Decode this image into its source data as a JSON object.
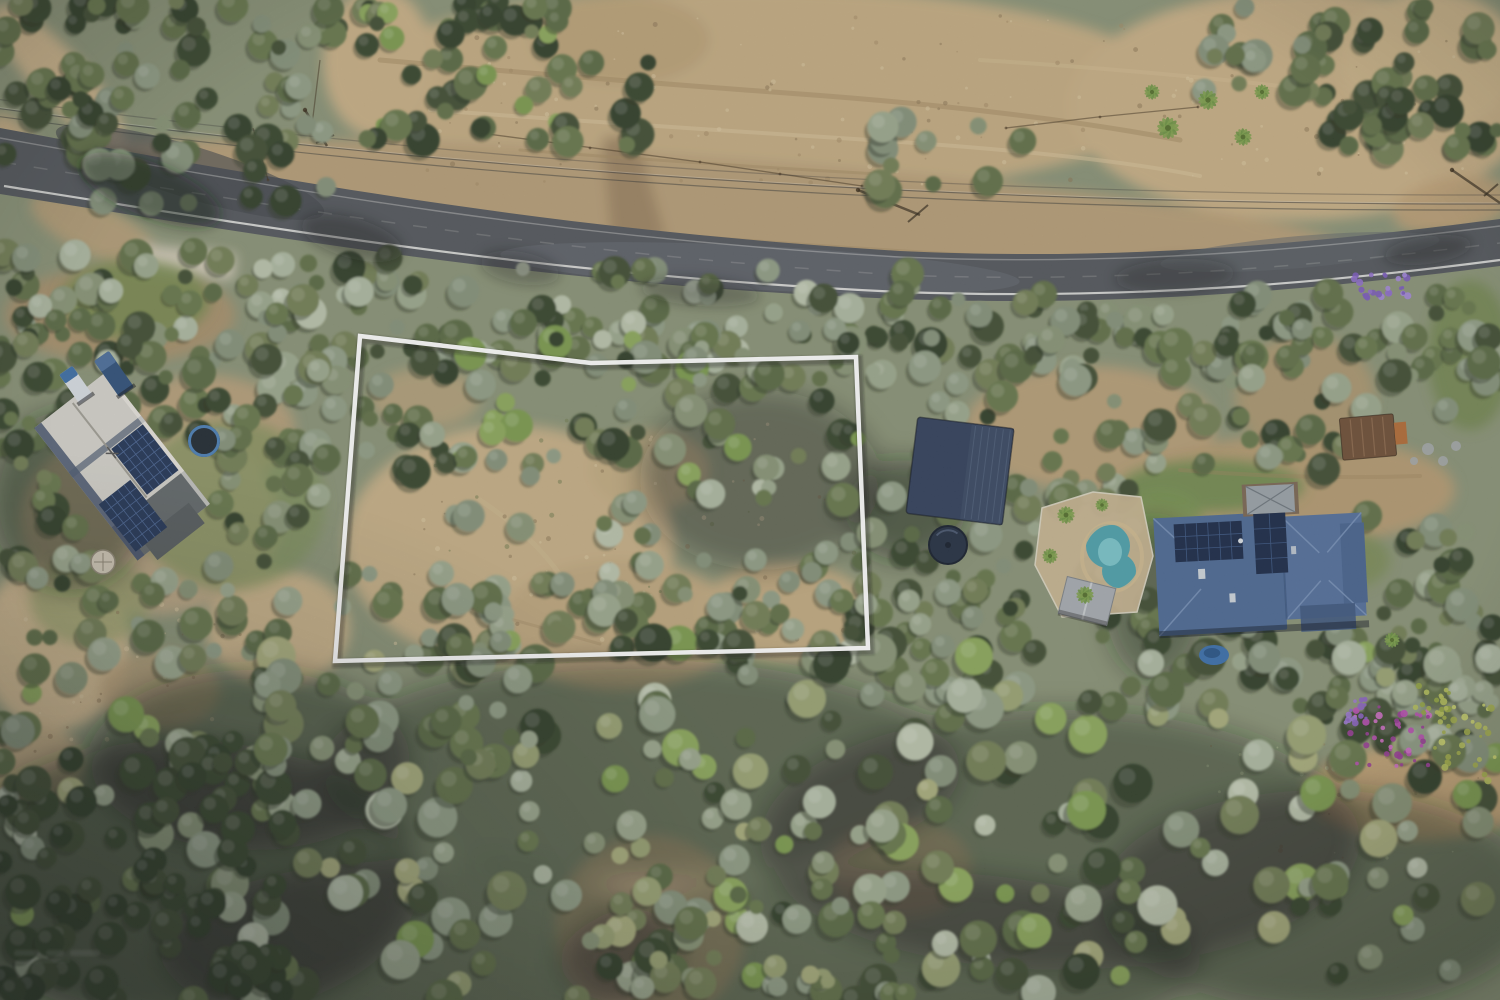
{
  "meta": {
    "type": "aerial-drone-photograph",
    "subject": "rural residential land parcel for sale, marked with white boundary outline, bushland with road at top",
    "width": 1500,
    "height": 1000,
    "seed": 7
  },
  "canvas": {
    "base": "#8a9377"
  },
  "overlay": {
    "boundary": {
      "points": "360,336 591,363 856,357 868,648 335,661",
      "stroke": "#ffffff",
      "stroke_width": 4.5,
      "shadow": "rgba(20,25,20,0.35)"
    }
  },
  "watermark": {
    "text_legible": false,
    "color": "#ffffff",
    "x": 14,
    "y": 950
  },
  "palette": {
    "trees": {
      "dark": [
        "#39462f",
        "#424f36",
        "#33402b"
      ],
      "mid": [
        "#5a6a44",
        "#68784d",
        "#737f56",
        "#627148"
      ],
      "grey": [
        "#85927a",
        "#909d85",
        "#9ba78d",
        "#889476"
      ],
      "silver": [
        "#acb7a0",
        "#b8c1aa"
      ],
      "bright": [
        "#7c9a50",
        "#8ca75c"
      ],
      "khaki": [
        "#99a273",
        "#a7ac7b"
      ]
    },
    "shadow": "#2c3526",
    "road_asphalt": "#54585d",
    "dirt_base": "#bfa77d"
  },
  "road": {
    "surface": "M0,128 C300,184 560,230 900,251 C1150,263 1360,237 1500,219 L1500,266 C1350,285 1150,308 900,299 C560,286 290,240 0,194 Z",
    "fill": "#54585d",
    "fog_line": "M4,186 C300,233 560,276 900,292 C1150,301 1355,279 1500,260",
    "top_line": "M0,138 C300,192 560,238 900,257 C1150,268 1360,243 1500,226",
    "center_line": "M2,162 C300,210 560,254 900,275 C1150,285 1360,260 1500,243",
    "light_patches": [
      {
        "cx": 760,
        "cy": 268,
        "rx": 260,
        "ry": 22,
        "rot": 3,
        "f": "#666c73",
        "o": 0.55
      },
      {
        "cx": 1300,
        "cy": 252,
        "rx": 140,
        "ry": 16,
        "rot": -5,
        "f": "#5f656b",
        "o": 0.5
      }
    ],
    "dark_patches": [
      {
        "cx": 190,
        "cy": 172,
        "rx": 140,
        "ry": 26,
        "rot": 17,
        "f": "#44484d",
        "o": 0.6
      }
    ]
  },
  "powerlines": {
    "wires": [
      {
        "d": "M-5,108 C400,163 900,205 1505,204",
        "o": 0.5
      },
      {
        "d": "M-5,116 C400,171 900,212 1505,210",
        "o": 0.45
      },
      {
        "d": "M-5,99 C420,155 900,196 1505,195",
        "o": 0.3
      }
    ],
    "glint": "M-5,107 C400,162 900,204 1505,203",
    "pole_shadows": [
      {
        "x1": 305,
        "y1": 110,
        "x2": 327,
        "y2": 146,
        "arm": [
          316,
          143,
          334,
          135
        ]
      },
      {
        "x1": 858,
        "y1": 190,
        "x2": 920,
        "y2": 215,
        "arm": [
          908,
          222,
          928,
          205
        ]
      },
      {
        "x1": 1452,
        "y1": 170,
        "x2": 1500,
        "y2": 203,
        "arm": [
          1484,
          196,
          1498,
          184
        ]
      }
    ]
  },
  "fences": [
    {
      "pts": "253,128 268,180"
    },
    {
      "pts": "480,133 700,162 862,186"
    },
    {
      "pts": "1006,128 1098,117 1198,107"
    },
    {
      "pts": "320,60 312,125"
    }
  ],
  "fence_posts": [
    [
      268,
      180
    ],
    [
      480,
      133
    ],
    [
      590,
      148
    ],
    [
      700,
      162
    ],
    [
      780,
      174
    ],
    [
      862,
      186
    ],
    [
      1006,
      128
    ],
    [
      1100,
      117
    ],
    [
      1198,
      107
    ]
  ],
  "dirt": [
    {
      "cx": 755,
      "cy": 92,
      "rx": 420,
      "ry": 105,
      "f": "#c2ab82"
    },
    {
      "cx": 1300,
      "cy": 105,
      "rx": 230,
      "ry": 115,
      "f": "#c6ae85"
    },
    {
      "cx": 1430,
      "cy": 60,
      "rx": 90,
      "ry": 70,
      "f": "#cbb489"
    },
    {
      "cx": 378,
      "cy": 62,
      "rx": 55,
      "ry": 75,
      "f": "#c6ae85"
    },
    {
      "cx": 620,
      "cy": 40,
      "rx": 90,
      "ry": 45,
      "f": "#b9a178"
    },
    {
      "cx": 700,
      "cy": 205,
      "rx": 650,
      "ry": 48,
      "rot": 4,
      "f": "#b59d77"
    },
    {
      "cx": 60,
      "cy": 78,
      "rx": 95,
      "ry": 26,
      "rot": 48,
      "f": "#c9b28a"
    },
    {
      "cx": 18,
      "cy": 148,
      "rx": 40,
      "ry": 18,
      "rot": 55,
      "f": "#c3ab83"
    },
    {
      "cx": 510,
      "cy": 545,
      "rx": 165,
      "ry": 120,
      "f": "#c4ae86"
    },
    {
      "cx": 620,
      "cy": 625,
      "rx": 120,
      "ry": 65,
      "f": "#bda67e"
    },
    {
      "cx": 785,
      "cy": 612,
      "rx": 85,
      "ry": 50,
      "f": "#c0a980"
    },
    {
      "cx": 425,
      "cy": 398,
      "rx": 55,
      "ry": 30,
      "f": "#b8a17a",
      "o": 0.8
    },
    {
      "cx": 650,
      "cy": 470,
      "rx": 60,
      "ry": 40,
      "f": "#bfa87f",
      "o": 0.75
    },
    {
      "cx": 278,
      "cy": 628,
      "rx": 72,
      "ry": 58,
      "f": "#c6b088"
    },
    {
      "cx": 55,
      "cy": 645,
      "rx": 75,
      "ry": 85,
      "f": "#ccb68e"
    },
    {
      "cx": 32,
      "cy": 765,
      "rx": 52,
      "ry": 42,
      "f": "#c2ab83",
      "o": 0.9
    },
    {
      "cx": 160,
      "cy": 690,
      "rx": 60,
      "ry": 40,
      "f": "#b49c75",
      "o": 0.8
    },
    {
      "cx": 1090,
      "cy": 428,
      "rx": 125,
      "ry": 62,
      "f": "#b59e77"
    },
    {
      "cx": 1295,
      "cy": 490,
      "rx": 160,
      "ry": 55,
      "f": "#b29a72"
    },
    {
      "cx": 1305,
      "cy": 395,
      "rx": 70,
      "ry": 60,
      "f": "#ae9670",
      "o": 0.85
    },
    {
      "cx": 1420,
      "cy": 792,
      "rx": 115,
      "ry": 48,
      "f": "#bfa276"
    },
    {
      "cx": 650,
      "cy": 930,
      "rx": 95,
      "ry": 95,
      "f": "#b7a07a",
      "o": 0.85
    },
    {
      "cx": 900,
      "cy": 868,
      "rx": 72,
      "ry": 50,
      "f": "#b29b76",
      "o": 0.8
    },
    {
      "cx": 120,
      "cy": 315,
      "rx": 115,
      "ry": 48,
      "f": "#a9906c",
      "o": 0.9
    },
    {
      "cx": 205,
      "cy": 430,
      "rx": 90,
      "ry": 55,
      "f": "#b8a07a",
      "o": 0.9
    },
    {
      "cx": 150,
      "cy": 520,
      "rx": 130,
      "ry": 95,
      "f": "#bca684",
      "o": 0.9
    },
    {
      "cx": 95,
      "cy": 230,
      "rx": 70,
      "ry": 25,
      "rot": 25,
      "f": "#b59d77",
      "o": 0.9
    },
    {
      "cx": 1452,
      "cy": 205,
      "rx": 60,
      "ry": 28,
      "rot": -10,
      "f": "#bb9f76",
      "o": 0.9
    }
  ],
  "driveway": {
    "pts": "602,138 636,134 666,238 612,246",
    "f": "#9b8362"
  },
  "apron": {
    "cx": 185,
    "cy": 262,
    "w": 100,
    "h": 26,
    "rot": 6,
    "f": "#cfc8b6"
  },
  "grass": [
    {
      "cx": 135,
      "cy": 300,
      "rx": 75,
      "ry": 40,
      "f": "#74884f",
      "o": 0.85
    },
    {
      "cx": 230,
      "cy": 505,
      "rx": 95,
      "ry": 85,
      "f": "#7c8f58",
      "o": 0.7
    },
    {
      "cx": 1212,
      "cy": 486,
      "rx": 92,
      "ry": 26,
      "f": "#6f8a4f",
      "o": 0.9
    },
    {
      "cx": 1162,
      "cy": 520,
      "rx": 40,
      "ry": 30,
      "f": "#779253",
      "o": 0.8
    },
    {
      "cx": 1470,
      "cy": 355,
      "rx": 42,
      "ry": 75,
      "f": "#70854e",
      "o": 0.8
    },
    {
      "cx": 1340,
      "cy": 560,
      "rx": 50,
      "ry": 30,
      "f": "#76894f",
      "o": 0.7
    },
    {
      "cx": 90,
      "cy": 600,
      "rx": 60,
      "ry": 45,
      "f": "#8a9a62",
      "o": 0.6
    }
  ],
  "dirt_streaks": [
    {
      "d": "M380,60 q200,18 420,34 t380,46",
      "s": "#a28a62",
      "w": 5,
      "o": 0.5
    },
    {
      "d": "M430,110 q220,16 440,30 t330,36",
      "s": "#d8c49c",
      "w": 4,
      "o": 0.5
    },
    {
      "d": "M520,150 q180,14 360,24",
      "s": "#a28a62",
      "w": 3,
      "o": 0.45
    },
    {
      "d": "M980,60 q160,10 300,26",
      "s": "#d2bd94",
      "w": 4,
      "o": 0.4
    },
    {
      "d": "M620,230 q300,26 640,38",
      "s": "#a08862",
      "w": 3,
      "o": 0.4
    },
    {
      "d": "M1180,470 q120,10 240,6",
      "s": "#9d8560",
      "w": 4,
      "o": 0.4
    },
    {
      "d": "M440,600 q90,24 160,44",
      "s": "#a8906a",
      "w": 3,
      "o": 0.5
    },
    {
      "d": "M480,500 q60,40 90,90",
      "s": "#cdb992",
      "w": 5,
      "o": 0.4
    }
  ],
  "speckle_regions": [
    {
      "x": 370,
      "y": 15,
      "w": 770,
      "h": 170,
      "n": 110,
      "cols": [
        "#8a7454",
        "#a18a64",
        "#d9c8a2"
      ]
    },
    {
      "x": 1160,
      "y": 30,
      "w": 320,
      "h": 150,
      "n": 50,
      "cols": [
        "#8a7454",
        "#d9c8a2"
      ]
    },
    {
      "x": 380,
      "y": 420,
      "w": 480,
      "h": 230,
      "n": 90,
      "cols": [
        "#8a7454",
        "#d9c8a2",
        "#6f7a4e"
      ]
    },
    {
      "x": 20,
      "y": 600,
      "w": 260,
      "h": 160,
      "n": 40,
      "cols": [
        "#8a7454",
        "#d9c8a2"
      ]
    },
    {
      "x": 1200,
      "y": 740,
      "w": 280,
      "h": 120,
      "n": 40,
      "cols": [
        "#c9d2a8",
        "#8a7454"
      ]
    }
  ],
  "canopy_shadows": [
    {
      "cx": 640,
      "cy": 770,
      "rx": 320,
      "ry": 110,
      "o": 0.4
    },
    {
      "cx": 180,
      "cy": 880,
      "rx": 240,
      "ry": 140,
      "o": 0.5
    },
    {
      "cx": 1060,
      "cy": 840,
      "rx": 300,
      "ry": 130,
      "o": 0.4
    },
    {
      "cx": 880,
      "cy": 960,
      "rx": 320,
      "ry": 90,
      "o": 0.4
    },
    {
      "cx": 420,
      "cy": 950,
      "rx": 260,
      "ry": 90,
      "o": 0.4
    },
    {
      "cx": 1320,
      "cy": 900,
      "rx": 220,
      "ry": 110,
      "o": 0.4
    },
    {
      "cx": 760,
      "cy": 480,
      "rx": 120,
      "ry": 90,
      "o": 0.35
    },
    {
      "cx": 905,
      "cy": 510,
      "rx": 60,
      "ry": 50,
      "o": 0.5
    },
    {
      "cx": 1155,
      "cy": 600,
      "rx": 50,
      "ry": 80,
      "o": 0.4
    },
    {
      "cx": 70,
      "cy": 500,
      "rx": 80,
      "ry": 90,
      "o": 0.45
    },
    {
      "cx": 250,
      "cy": 760,
      "rx": 160,
      "ry": 90,
      "o": 0.45
    }
  ],
  "tree_regions": [
    [
      0,
      0,
      140,
      155,
      26,
      [
        "dark",
        "mid"
      ]
    ],
    [
      70,
      0,
      300,
      205,
      64,
      [
        "dark",
        "mid",
        "grey"
      ]
    ],
    [
      365,
      0,
      200,
      140,
      46,
      [
        "mid",
        "dark",
        "bright"
      ]
    ],
    [
      1310,
      0,
      190,
      155,
      46,
      [
        "dark",
        "mid"
      ]
    ],
    [
      1195,
      0,
      140,
      95,
      16,
      [
        "mid",
        "grey"
      ]
    ],
    [
      545,
      55,
      120,
      90,
      10,
      [
        "mid",
        "dark"
      ]
    ],
    [
      870,
      120,
      160,
      80,
      12,
      [
        "grey",
        "mid"
      ]
    ],
    [
      0,
      250,
      420,
      112,
      62,
      [
        "grey",
        "mid",
        "silver",
        "dark"
      ]
    ],
    [
      400,
      268,
      520,
      100,
      70,
      [
        "grey",
        "mid",
        "silver",
        "dark"
      ]
    ],
    [
      900,
      292,
      600,
      80,
      58,
      [
        "grey",
        "mid",
        "dark"
      ]
    ],
    [
      360,
      335,
      505,
      148,
      80,
      [
        "mid",
        "grey",
        "dark",
        "bright"
      ]
    ],
    [
      430,
      465,
      430,
      200,
      38,
      [
        "grey",
        "mid",
        "silver"
      ]
    ],
    [
      340,
      555,
      260,
      110,
      24,
      [
        "mid",
        "grey"
      ]
    ],
    [
      600,
      555,
      270,
      110,
      30,
      [
        "mid",
        "dark",
        "grey"
      ]
    ],
    [
      0,
      318,
      210,
      125,
      28,
      [
        "dark",
        "mid"
      ]
    ],
    [
      0,
      400,
      95,
      185,
      18,
      [
        "mid",
        "dark"
      ]
    ],
    [
      195,
      330,
      150,
      125,
      22,
      [
        "mid",
        "grey",
        "dark"
      ]
    ],
    [
      215,
      430,
      130,
      140,
      22,
      [
        "mid",
        "grey",
        "dark"
      ]
    ],
    [
      30,
      555,
      265,
      125,
      30,
      [
        "mid",
        "grey"
      ]
    ],
    [
      865,
      330,
      300,
      305,
      78,
      [
        "dark",
        "mid",
        "grey"
      ]
    ],
    [
      865,
      590,
      290,
      120,
      28,
      [
        "mid",
        "dark",
        "grey"
      ]
    ],
    [
      1150,
      300,
      355,
      175,
      50,
      [
        "mid",
        "grey",
        "dark"
      ]
    ],
    [
      1365,
      515,
      135,
      190,
      26,
      [
        "mid",
        "dark",
        "grey"
      ]
    ],
    [
      1150,
      615,
      350,
      130,
      38,
      [
        "mid",
        "dark",
        "grey"
      ]
    ],
    [
      0,
      640,
      1500,
      365,
      300,
      [
        "mid",
        "grey",
        "dark",
        "silver",
        "khaki",
        "bright"
      ],
      9,
      20
    ],
    [
      0,
      755,
      305,
      245,
      66,
      [
        "dark"
      ],
      9,
      19
    ],
    [
      250,
      645,
      280,
      120,
      26,
      [
        "mid",
        "grey"
      ]
    ],
    [
      580,
      800,
      340,
      200,
      40,
      [
        "khaki",
        "mid",
        "grey"
      ]
    ]
  ],
  "road_shadows": [
    {
      "cx": 150,
      "cy": 190,
      "rx": 75,
      "ry": 27,
      "rot": 22,
      "o": 0.5
    },
    {
      "cx": 352,
      "cy": 238,
      "rx": 52,
      "ry": 20,
      "rot": 16,
      "o": 0.35
    },
    {
      "cx": 520,
      "cy": 268,
      "rx": 40,
      "ry": 16,
      "rot": 10,
      "o": 0.3
    },
    {
      "cx": 1175,
      "cy": 276,
      "rx": 60,
      "ry": 17,
      "rot": -3,
      "o": 0.3
    },
    {
      "cx": 1428,
      "cy": 250,
      "rx": 44,
      "ry": 14,
      "rot": -8,
      "o": 0.35
    },
    {
      "cx": 700,
      "cy": 292,
      "rx": 60,
      "ry": 14,
      "rot": 4,
      "o": 0.3
    }
  ],
  "features": {
    "left_house": {
      "cx": 122,
      "cy": 466,
      "rot": -38,
      "w": 92,
      "h": 168,
      "roof": "#d2d0c9",
      "ridge": "#9a988f",
      "edge": "#46546c",
      "band": "#4e5c72",
      "end": "#63696b",
      "end2": "#575d5f",
      "eave": "#e9e7e0",
      "solar": "#253757",
      "grid": "#4a6490",
      "arrays": [
        [
          2,
          -20,
          40,
          58
        ],
        [
          -42,
          16,
          40,
          60
        ]
      ]
    },
    "vehicles": [
      {
        "cx": 76,
        "cy": 385,
        "rot": -35,
        "w": 16,
        "h": 36,
        "body": "#d6dbe1",
        "cab": "#3e6ea5"
      },
      {
        "cx": 114,
        "cy": 374,
        "rot": -35,
        "w": 18,
        "h": 44,
        "body": "#31517a",
        "cab": "#4c6f9b"
      }
    ],
    "trampoline": {
      "cx": 204,
      "cy": 441,
      "r": 16,
      "mat": "#232c33",
      "rim": "#4d7fb5"
    },
    "tank_small": {
      "cx": 103,
      "cy": 562,
      "r": 12,
      "fill": "#cdc5b4",
      "rim": "#8d8574"
    },
    "shed": {
      "cx": 960,
      "cy": 471,
      "rot": 7,
      "w": 97,
      "h": 97,
      "roof": "#33415c",
      "half": "#3a4963",
      "stripe": "#4d5d77"
    },
    "water_tank": {
      "cx": 948,
      "cy": 545,
      "r": 19,
      "fill": "#263143",
      "rim": "#18202e",
      "hi": "#52617a"
    },
    "pool": {
      "fence_pts": "1042,508 1093,492 1141,497 1153,556 1137,612 1062,617 1035,565",
      "pad": "#c9b693",
      "fence": "#ded7c5",
      "water": "#4fa0ab",
      "light": "#85cbd0",
      "coping": "#cdb88f",
      "c1": [
        1108,
        546,
        22
      ],
      "c2": [
        1119,
        571,
        17
      ],
      "ring": [
        1112,
        557,
        30,
        34
      ]
    },
    "pergola": {
      "cx": 1087,
      "cy": 601,
      "rot": 14,
      "w": 50,
      "h": 38,
      "fill": "#a6abb0",
      "ridge": "#c6cacd",
      "edge": "#7e8387"
    },
    "right_house": {
      "cx": 1258,
      "cy": 568,
      "rot": -3,
      "main": "#4e6a94",
      "wing": "#54709b",
      "wing2": "#49648e",
      "hip": "#7c95ba",
      "valley": "#35507a",
      "solar": "#1d2c49",
      "grid": "#3c5680",
      "portico_deck": "#7b6854",
      "portico_roof": "#99a1a7",
      "portico_edge": "#6f777e",
      "sky": "#ccd3d9",
      "deck": "#3f587e"
    },
    "tarp": {
      "cx": 1214,
      "cy": 655,
      "rx": 15,
      "ry": 10,
      "fill": "#3d70ab",
      "inner": "#2b5587"
    },
    "brown_shed": {
      "cx": 1368,
      "cy": 437,
      "rot": -5,
      "w": 54,
      "h": 42,
      "fill": "#6f5038",
      "stripe": "#8a684c",
      "attach": "#b06c38"
    },
    "stones": [
      [
        1428,
        449,
        6
      ],
      [
        1443,
        461,
        5
      ],
      [
        1456,
        446,
        5
      ],
      [
        1414,
        461,
        4
      ]
    ],
    "palms": [
      [
        1168,
        128,
        1
      ],
      [
        1208,
        100,
        0.9
      ],
      [
        1243,
        137,
        0.8
      ],
      [
        1262,
        92,
        0.7
      ],
      [
        1152,
        92,
        0.7
      ],
      [
        1066,
        515,
        0.8
      ],
      [
        1050,
        556,
        0.7
      ],
      [
        1085,
        595,
        0.8
      ],
      [
        1102,
        505,
        0.6
      ],
      [
        1392,
        640,
        0.7
      ]
    ],
    "palm_colors": [
      "#7fa04f",
      "#6d9245"
    ],
    "flower_clusters": [
      {
        "cx": 1382,
        "cy": 286,
        "rx": 28,
        "ry": 12,
        "n": 26,
        "cols": [
          "#8f6fc9",
          "#a287d8",
          "#7b5cba"
        ]
      },
      {
        "cx": 1390,
        "cy": 737,
        "rx": 40,
        "ry": 34,
        "n": 42,
        "cols": [
          "#b94fb2",
          "#cf6ec5",
          "#993d97"
        ]
      },
      {
        "cx": 1348,
        "cy": 710,
        "rx": 18,
        "ry": 13,
        "n": 14,
        "cols": [
          "#9b78cf",
          "#8a63c0"
        ]
      },
      {
        "cx": 1462,
        "cy": 742,
        "rx": 34,
        "ry": 40,
        "n": 34,
        "cols": [
          "#b6c05c",
          "#a2ad4b",
          "#c9d06e"
        ]
      },
      {
        "cx": 1435,
        "cy": 700,
        "rx": 20,
        "ry": 16,
        "n": 16,
        "cols": [
          "#b6c05c",
          "#95a544"
        ]
      }
    ]
  }
}
